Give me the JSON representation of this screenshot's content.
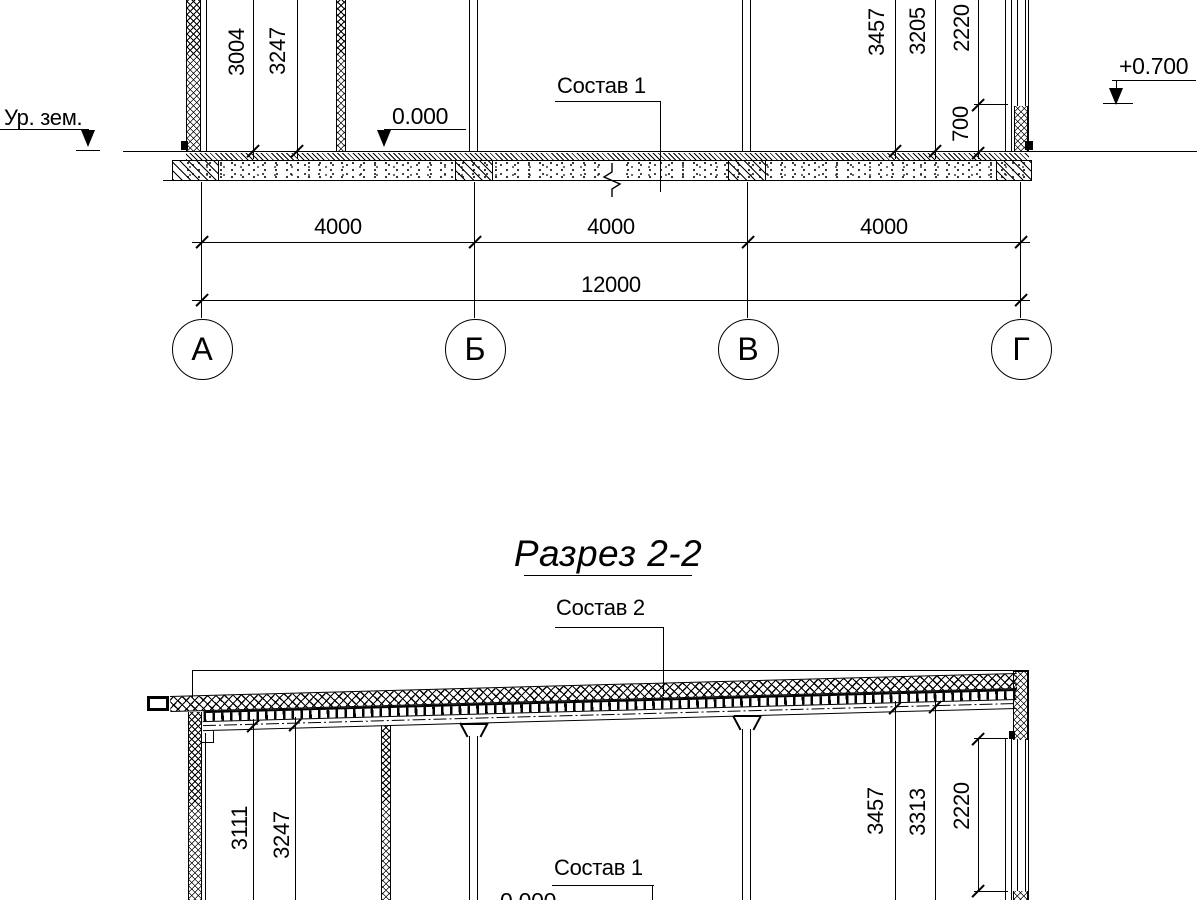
{
  "colors": {
    "ink": "#000000",
    "paper": "#ffffff"
  },
  "title": "Разрез 2-2",
  "section1": {
    "ground_label": "Ур. зем.",
    "elev_zero": "0.000",
    "elev_top": "+0.700",
    "layer_callout": "Состав 1",
    "dim_left_1": "3004",
    "dim_left_2": "3247",
    "dim_right_1": "3457",
    "dim_right_2": "3205",
    "dim_right_3": "2220",
    "dim_sill": "700",
    "span_1": "4000",
    "span_2": "4000",
    "span_3": "4000",
    "total": "12000",
    "axis_1": "А",
    "axis_2": "Б",
    "axis_3": "В",
    "axis_4": "Г"
  },
  "section2": {
    "layer_callout_roof": "Состав 2",
    "layer_callout_floor": "Состав 1",
    "elev_zero": "0.000",
    "dim_left_1": "3111",
    "dim_left_2": "3247",
    "dim_right_1": "3457",
    "dim_right_2": "3313",
    "dim_right_3": "2220",
    "dim_sill": "700"
  }
}
